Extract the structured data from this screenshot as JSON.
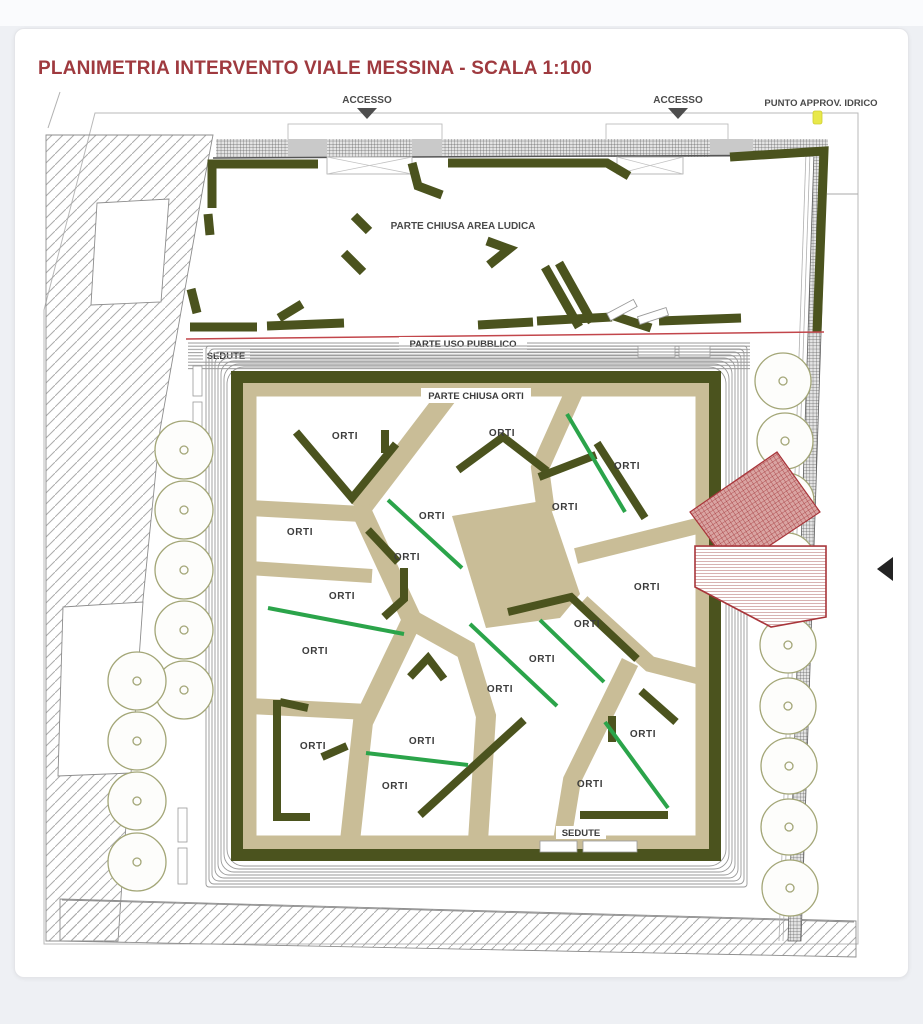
{
  "window": {
    "background_color": "#eef0f4",
    "card_color": "#ffffff"
  },
  "title": {
    "text": "PLANIMETRIA INTERVENTO VIALE MESSINA - SCALA 1:100",
    "color": "#9f3a3f"
  },
  "plan": {
    "scale": "1:100",
    "labels": {
      "accesso": "ACCESSO",
      "punto_approv_idrico": "PUNTO APPROV. IDRICO",
      "parte_chiusa_area_ludica": "PARTE CHIUSA  AREA LUDICA",
      "parte_uso_pubblico": "PARTE USO PUBBLICO",
      "parte_chiusa_orti": "PARTE CHIUSA ORTI",
      "sedute": "SEDUTE",
      "orti": "ORTI"
    },
    "counts": {
      "orti_plot_labels": 18,
      "access_points": 2,
      "green_hedge_lines": 7,
      "trees_left": 9,
      "trees_right": 9
    },
    "colors": {
      "hedge_olive": "#4b531e",
      "path_beige": "#c9bd97",
      "new_hedge_green": "#2ba44a",
      "red_outline": "#a8353a",
      "idrico_yellow": "#e8e84a",
      "walkway_line_gray": "#999999"
    }
  },
  "viewer": {
    "prev_arrow_icon": "left-triangle"
  }
}
